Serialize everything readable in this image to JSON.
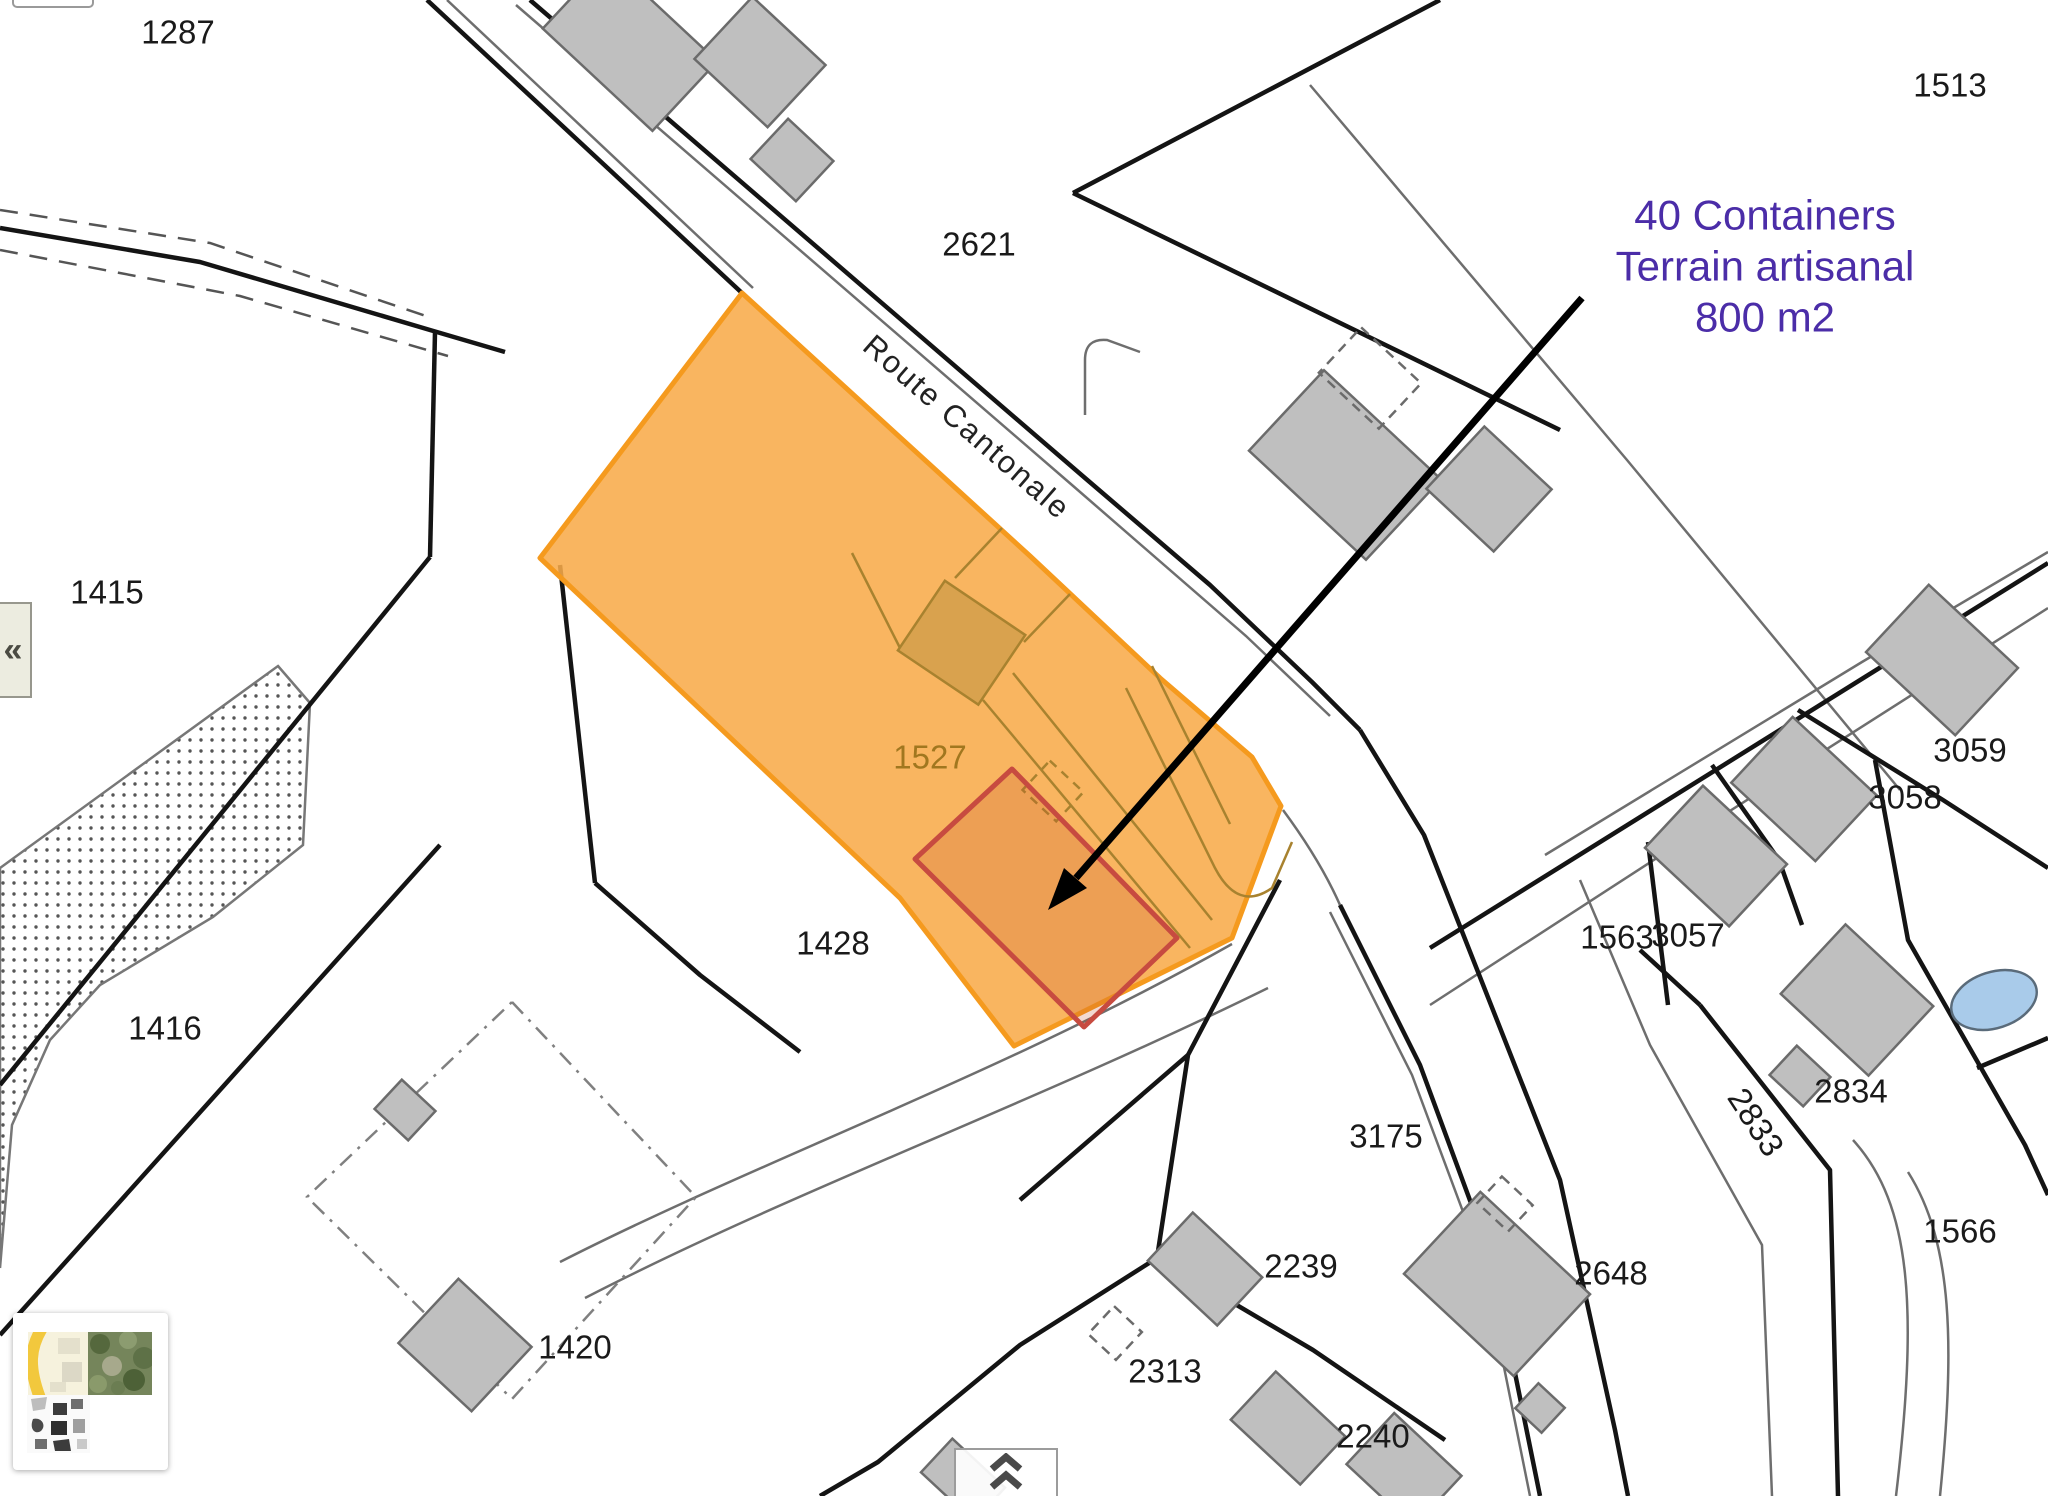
{
  "map": {
    "road_label": {
      "text": "Route Cantonale",
      "x": 967,
      "y": 427,
      "rotation": 41,
      "color": "#222222",
      "font_size": 31
    },
    "annotation": {
      "lines": [
        "40 Containers",
        "Terrain artisanal",
        "800 m2"
      ],
      "x": 1765,
      "start_y": 215,
      "line_height": 51,
      "color": "#4B2DA8",
      "font_size": 42
    },
    "highlighted_parcel": {
      "id": "1527",
      "label_x": 930,
      "label_y": 757,
      "label_color": "#A1771F",
      "fill": "#F8AB4A",
      "stroke": "#F59A1E"
    },
    "proposed_area": {
      "outline_color": "#C74B40"
    },
    "label_color": "#1A1A1A",
    "label_font_size": 33,
    "parcel_labels": [
      {
        "id": "1287",
        "x": 178,
        "y": 32
      },
      {
        "id": "1513",
        "x": 1950,
        "y": 85
      },
      {
        "id": "2621",
        "x": 979,
        "y": 244
      },
      {
        "id": "1415",
        "x": 107,
        "y": 592
      },
      {
        "id": "1428",
        "x": 833,
        "y": 943
      },
      {
        "id": "1416",
        "x": 165,
        "y": 1028
      },
      {
        "id": "1420",
        "x": 575,
        "y": 1347
      },
      {
        "id": "3175",
        "x": 1386,
        "y": 1136
      },
      {
        "id": "2239",
        "x": 1301,
        "y": 1266
      },
      {
        "id": "2313",
        "x": 1165,
        "y": 1371
      },
      {
        "id": "2240",
        "x": 1373,
        "y": 1436
      },
      {
        "id": "2648",
        "x": 1611,
        "y": 1273
      },
      {
        "id": "1566",
        "x": 1960,
        "y": 1231
      },
      {
        "id": "2834",
        "x": 1851,
        "y": 1091
      },
      {
        "id": "2833",
        "x": 1756,
        "y": 1122,
        "rotation": 57
      },
      {
        "id": "1563",
        "x": 1617,
        "y": 937
      },
      {
        "id": "3057",
        "x": 1688,
        "y": 935
      },
      {
        "id": "3058",
        "x": 1905,
        "y": 797
      },
      {
        "id": "3059",
        "x": 1970,
        "y": 750
      }
    ],
    "colors": {
      "boundary": "#141414",
      "road_edge": "#6E6E6E",
      "building_fill": "#BFBFBF",
      "building_stroke": "#6B6B6B",
      "building_tan": "#D9A24E",
      "parcel_detail": "#A8822F",
      "pond": "#A9CBEA",
      "forest_dot": "#555555",
      "arrow": "#000000"
    }
  },
  "controls": {
    "collapse_panel_button": {
      "glyph": "«",
      "icon": "chevrons-left-icon"
    },
    "expand_panel_button": {
      "icon": "chevrons-up-icon"
    },
    "basemap_switcher": {
      "tile_names": [
        "street-map-tile",
        "aerial-map-tile",
        "bw-map-tile"
      ]
    }
  }
}
